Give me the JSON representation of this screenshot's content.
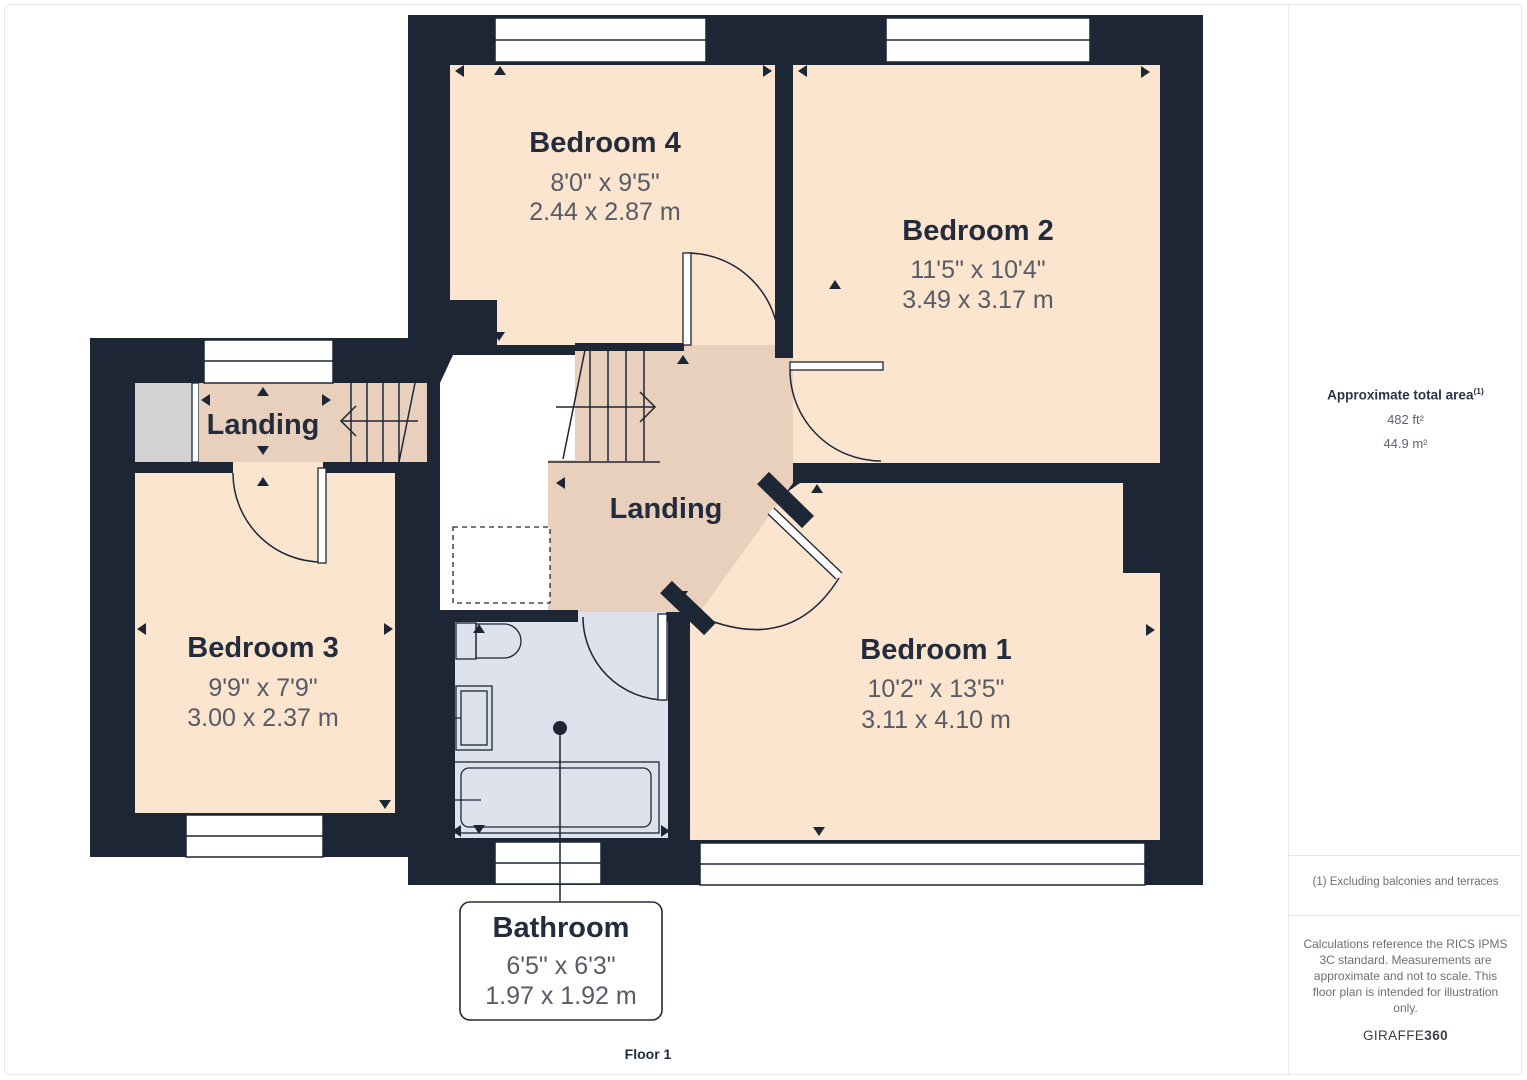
{
  "plan": {
    "floor_label": "Floor 1",
    "rooms": [
      {
        "name": "Bedroom 4",
        "dims_imperial": "8'0\" x 9'5\"",
        "dims_metric": "2.44 x 2.87 m"
      },
      {
        "name": "Bedroom 2",
        "dims_imperial": "11'5\" x 10'4\"",
        "dims_metric": "3.49 x 3.17 m"
      },
      {
        "name": "Bedroom 3",
        "dims_imperial": "9'9\" x 7'9\"",
        "dims_metric": "3.00 x 2.37 m"
      },
      {
        "name": "Bedroom 1",
        "dims_imperial": "10'2\" x 13'5\"",
        "dims_metric": "3.11 x 4.10 m"
      },
      {
        "name": "Bathroom",
        "dims_imperial": "6'5\" x 6'3\"",
        "dims_metric": "1.97 x 1.92 m"
      }
    ],
    "landings": [
      {
        "label": "Landing"
      },
      {
        "label": "Landing"
      }
    ],
    "colors": {
      "wall": "#1d2635",
      "room_fill": "#fbe5cf",
      "landing_fill": "#e9d0bd",
      "bathroom_fill": "#dde2ec",
      "closet_fill": "#d2d2d2",
      "window_fill": "#ffffff",
      "title_text": "#232c3d",
      "dimension_text": "#565b66"
    }
  },
  "sidebar": {
    "area_title": "Approximate total area",
    "area_title_superscript": "(1)",
    "area_imperial": "482 ft²",
    "area_metric": "44.9 m²",
    "footnote": "(1) Excluding balconies and terraces",
    "disclaimer": "Calculations reference the RICS IPMS 3C standard. Measurements are approximate and not to scale. This floor plan is intended for illustration only.",
    "brand_prefix": "GIRAFFE",
    "brand_suffix": "360"
  }
}
